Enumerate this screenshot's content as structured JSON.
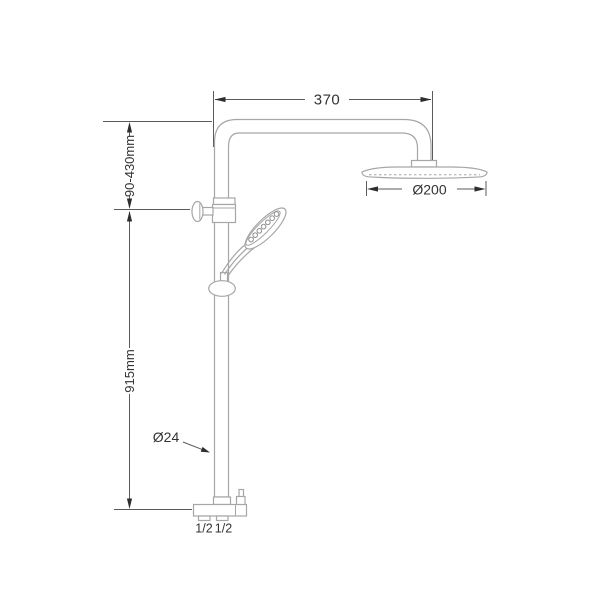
{
  "diagram": {
    "labels": {
      "arm_width": "370",
      "top_offset": "90-430mm",
      "riser_height": "915mm",
      "head_diameter": "Ø200",
      "pipe_diameter": "Ø24",
      "left_inlet": "1/2",
      "right_inlet": "1/2"
    },
    "colors": {
      "line": "#a6a6a6",
      "dimension": "#5a5a5a",
      "text": "#333333",
      "background": "#ffffff"
    }
  }
}
